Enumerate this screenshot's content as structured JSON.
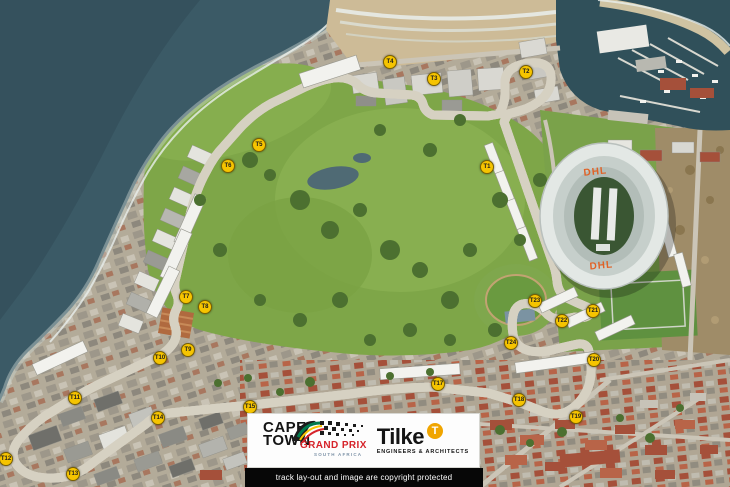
{
  "map": {
    "title": "Cape Town Grand Prix circuit aerial map",
    "stadium_roof_label_top": "DHL",
    "stadium_roof_label_bottom": "DHL",
    "turn_markers": [
      {
        "label": "T1",
        "x": 487,
        "y": 167
      },
      {
        "label": "T2",
        "x": 526,
        "y": 72
      },
      {
        "label": "T3",
        "x": 434,
        "y": 79
      },
      {
        "label": "T4",
        "x": 390,
        "y": 62
      },
      {
        "label": "T5",
        "x": 259,
        "y": 145
      },
      {
        "label": "T6",
        "x": 228,
        "y": 166
      },
      {
        "label": "T7",
        "x": 186,
        "y": 297
      },
      {
        "label": "T8",
        "x": 205,
        "y": 307
      },
      {
        "label": "T9",
        "x": 188,
        "y": 350
      },
      {
        "label": "T10",
        "x": 160,
        "y": 358
      },
      {
        "label": "T11",
        "x": 75,
        "y": 398
      },
      {
        "label": "T12",
        "x": 6,
        "y": 459
      },
      {
        "label": "T13",
        "x": 73,
        "y": 474
      },
      {
        "label": "T14",
        "x": 158,
        "y": 418
      },
      {
        "label": "T15",
        "x": 250,
        "y": 407
      },
      {
        "label": "T17",
        "x": 438,
        "y": 384
      },
      {
        "label": "T18",
        "x": 519,
        "y": 400
      },
      {
        "label": "T19",
        "x": 576,
        "y": 417
      },
      {
        "label": "T20",
        "x": 594,
        "y": 360
      },
      {
        "label": "T21",
        "x": 593,
        "y": 311
      },
      {
        "label": "T22",
        "x": 562,
        "y": 321
      },
      {
        "label": "T23",
        "x": 535,
        "y": 301
      },
      {
        "label": "T24",
        "x": 511,
        "y": 343
      }
    ]
  },
  "logo_box": {
    "cape": "CAPE",
    "town": "TOWN",
    "grand_prix": "GRAND PRIX",
    "south_africa": "SOUTH AFRICA",
    "tilke": "Tilke",
    "tilke_badge": "T",
    "tilke_subtitle": "ENGINEERS & ARCHITECTS"
  },
  "caption": "track lay-out and image are copyright protected",
  "colors": {
    "marker": "#f6c400",
    "track": "#5a1e14",
    "grand_prix_red": "#d6232a",
    "tilke_orange": "#f0a500",
    "dhl_orange": "#e06226"
  }
}
